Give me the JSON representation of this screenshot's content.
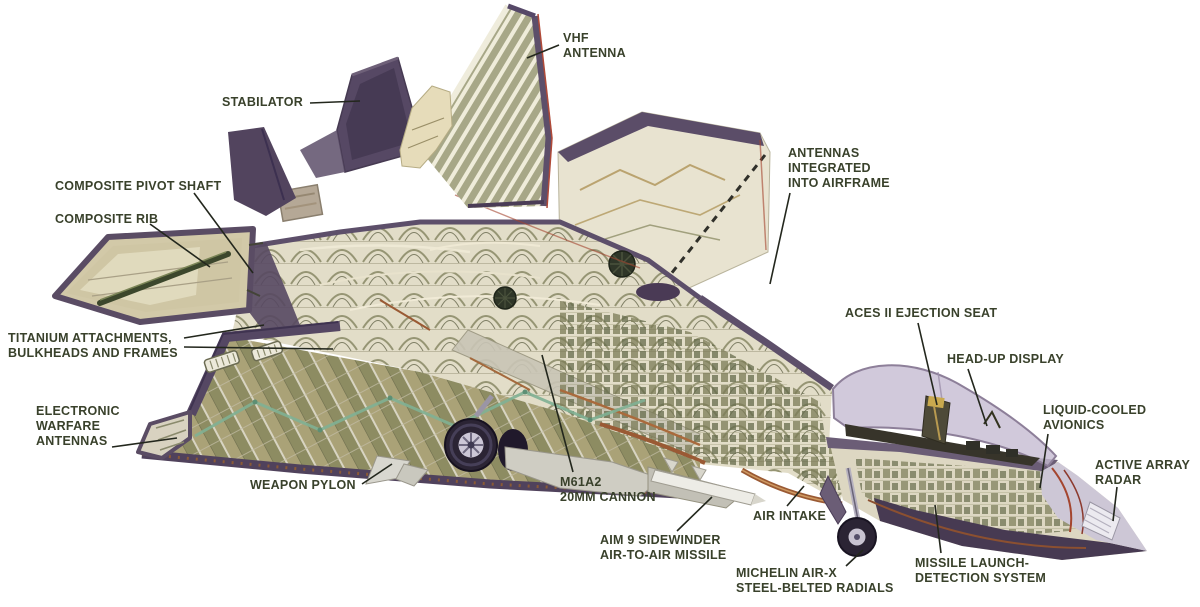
{
  "colors": {
    "background": "#ffffff",
    "label_text": "#39412b",
    "leader_line": "#23271d",
    "skin_purple": "#5a4c66",
    "interior_cream": "#e2ddc8",
    "structure_olive": "#8f8f6d",
    "wing_khaki": "#aaa277",
    "harness_teal": "#7fb093",
    "rust_copper": "#9a5a34",
    "canopy": "#c6bbd2",
    "tire_dark": "#2b2434"
  },
  "labels": [
    {
      "id": "vhf-antenna",
      "lines": [
        "VHF",
        "ANTENNA"
      ],
      "x": 563,
      "y": 31,
      "leaders": [
        [
          559,
          45,
          527,
          58
        ]
      ]
    },
    {
      "id": "stabilator",
      "lines": [
        "STABILATOR"
      ],
      "x": 222,
      "y": 95,
      "leaders": [
        [
          310,
          103,
          360,
          101
        ]
      ]
    },
    {
      "id": "composite-pivot-shaft",
      "lines": [
        "COMPOSITE PIVOT SHAFT"
      ],
      "x": 55,
      "y": 179,
      "leaders": [
        [
          194,
          193,
          253,
          273
        ]
      ]
    },
    {
      "id": "composite-rib",
      "lines": [
        "COMPOSITE RIB"
      ],
      "x": 55,
      "y": 212,
      "leaders": [
        [
          150,
          224,
          210,
          267
        ]
      ]
    },
    {
      "id": "titanium-attachments",
      "lines": [
        "TITANIUM ATTACHMENTS,",
        "BULKHEADS AND FRAMES"
      ],
      "x": 8,
      "y": 331,
      "leaders": [
        [
          184,
          338,
          264,
          325
        ],
        [
          184,
          347,
          333,
          349
        ]
      ]
    },
    {
      "id": "electronic-warfare-antennas",
      "lines": [
        "ELECTRONIC",
        "WARFARE",
        "ANTENNAS"
      ],
      "x": 36,
      "y": 404,
      "leaders": [
        [
          112,
          447,
          177,
          438
        ]
      ]
    },
    {
      "id": "weapon-pylon",
      "lines": [
        "WEAPON PYLON"
      ],
      "x": 250,
      "y": 478,
      "leaders": [
        [
          362,
          484,
          392,
          464
        ]
      ]
    },
    {
      "id": "m61a2-cannon",
      "lines": [
        "M61A2",
        "20MM CANNON"
      ],
      "x": 560,
      "y": 475,
      "leaders": [
        [
          573,
          472,
          542,
          355
        ]
      ]
    },
    {
      "id": "aim9-sidewinder",
      "lines": [
        "AIM 9 SIDEWINDER",
        "AIR-TO-AIR MISSILE"
      ],
      "x": 600,
      "y": 533,
      "leaders": [
        [
          677,
          531,
          712,
          497
        ]
      ]
    },
    {
      "id": "air-intake",
      "lines": [
        "AIR INTAKE"
      ],
      "x": 753,
      "y": 509,
      "leaders": [
        [
          787,
          506,
          804,
          486
        ]
      ]
    },
    {
      "id": "michelin-radials",
      "lines": [
        "MICHELIN AIR-X",
        "STEEL-BELTED RADIALS"
      ],
      "x": 736,
      "y": 566,
      "leaders": [
        [
          846,
          566,
          863,
          550
        ]
      ]
    },
    {
      "id": "missile-launch-detection",
      "lines": [
        "MISSILE LAUNCH-",
        "DETECTION SYSTEM"
      ],
      "x": 915,
      "y": 556,
      "leaders": [
        [
          941,
          553,
          935,
          505
        ]
      ]
    },
    {
      "id": "antennas-integrated",
      "lines": [
        "ANTENNAS",
        "INTEGRATED",
        "INTO AIRFRAME"
      ],
      "x": 788,
      "y": 146,
      "leaders": [
        [
          790,
          193,
          770,
          284
        ]
      ]
    },
    {
      "id": "aces-ejection-seat",
      "lines": [
        "ACES II EJECTION SEAT"
      ],
      "x": 845,
      "y": 306,
      "leaders": [
        [
          918,
          323,
          937,
          405
        ]
      ]
    },
    {
      "id": "head-up-display",
      "lines": [
        "HEAD-UP DISPLAY"
      ],
      "x": 947,
      "y": 352,
      "leaders": [
        [
          968,
          369,
          987,
          426
        ]
      ]
    },
    {
      "id": "liquid-cooled-avionics",
      "lines": [
        "LIQUID-COOLED",
        "AVIONICS"
      ],
      "x": 1043,
      "y": 403,
      "leaders": [
        [
          1048,
          434,
          1040,
          488
        ]
      ]
    },
    {
      "id": "active-array-radar",
      "lines": [
        "ACTIVE ARRAY",
        "RADAR"
      ],
      "x": 1095,
      "y": 458,
      "leaders": [
        [
          1117,
          487,
          1113,
          521
        ]
      ]
    }
  ]
}
